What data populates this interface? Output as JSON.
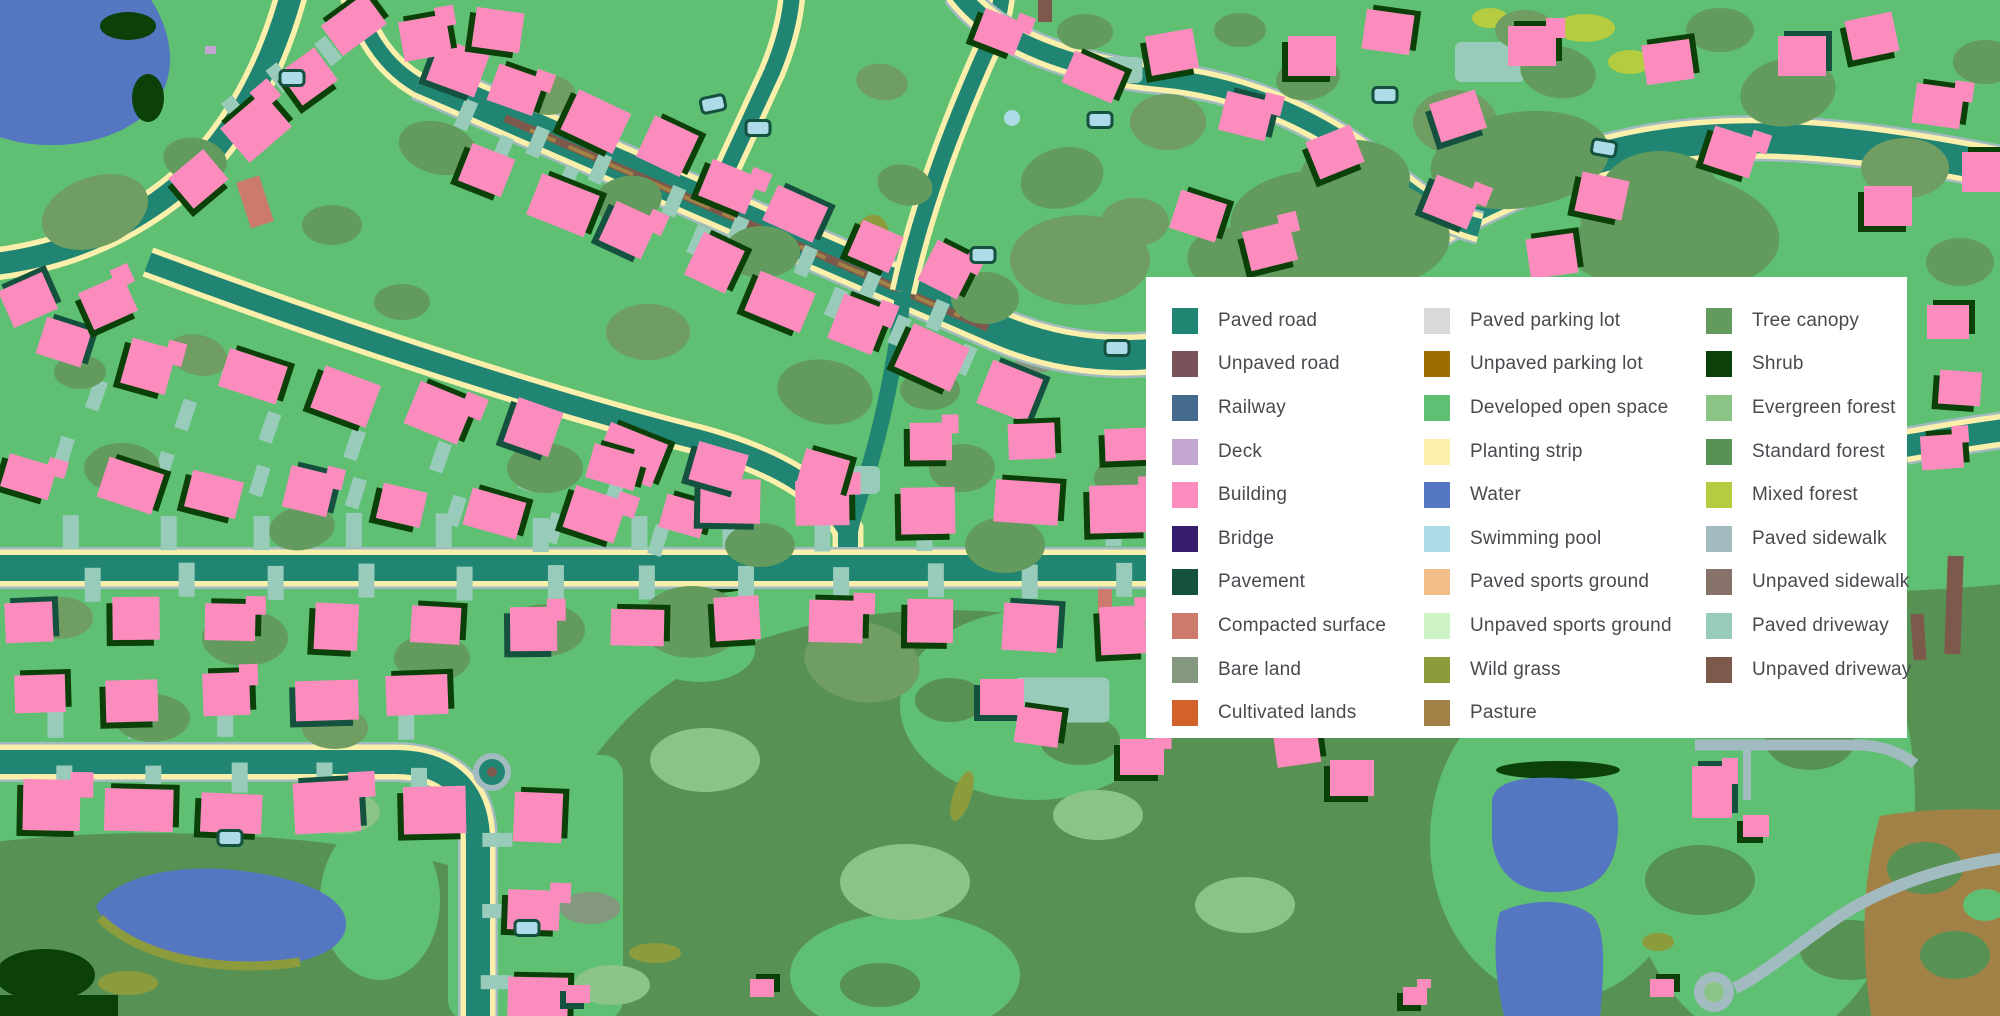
{
  "legend": {
    "columns": [
      {
        "items": [
          {
            "label": "Paved road",
            "color": "#218573"
          },
          {
            "label": "Unpaved road",
            "color": "#7b515a"
          },
          {
            "label": "Railway",
            "color": "#456a8d"
          },
          {
            "label": "Deck",
            "color": "#c3a7d1"
          },
          {
            "label": "Building",
            "color": "#fb8cbd"
          },
          {
            "label": "Bridge",
            "color": "#371d6d"
          },
          {
            "label": "Pavement",
            "color": "#14523f"
          },
          {
            "label": "Compacted surface",
            "color": "#cb7a6c"
          },
          {
            "label": "Bare land",
            "color": "#84977f"
          },
          {
            "label": "Cultivated lands",
            "color": "#d2612a"
          }
        ]
      },
      {
        "items": [
          {
            "label": "Paved parking lot",
            "color": "#d9d9d9"
          },
          {
            "label": "Unpaved parking lot",
            "color": "#9c6d00"
          },
          {
            "label": "Developed open space",
            "color": "#5fbf72"
          },
          {
            "label": "Planting strip",
            "color": "#faefab"
          },
          {
            "label": "Water",
            "color": "#5576c1"
          },
          {
            "label": "Swimming pool",
            "color": "#aedbe8"
          },
          {
            "label": "Paved sports ground",
            "color": "#f3bd8a"
          },
          {
            "label": "Unpaved sports ground",
            "color": "#cdf2c5"
          },
          {
            "label": "Wild grass",
            "color": "#8c9c3d"
          },
          {
            "label": "Pasture",
            "color": "#a28147"
          }
        ]
      },
      {
        "items": [
          {
            "label": "Tree canopy",
            "color": "#639b5e"
          },
          {
            "label": "Shrub",
            "color": "#0b4008"
          },
          {
            "label": "Evergreen forest",
            "color": "#8cc487"
          },
          {
            "label": "Standard forest",
            "color": "#579254"
          },
          {
            "label": "Mixed forest",
            "color": "#b5cc40"
          },
          {
            "label": "Paved sidewalk",
            "color": "#a2bbc0"
          },
          {
            "label": "Unpaved sidewalk",
            "color": "#877369"
          },
          {
            "label": "Paved driveway",
            "color": "#98cbba"
          },
          {
            "label": "Unpaved driveway",
            "color": "#7c594b"
          }
        ]
      }
    ]
  }
}
